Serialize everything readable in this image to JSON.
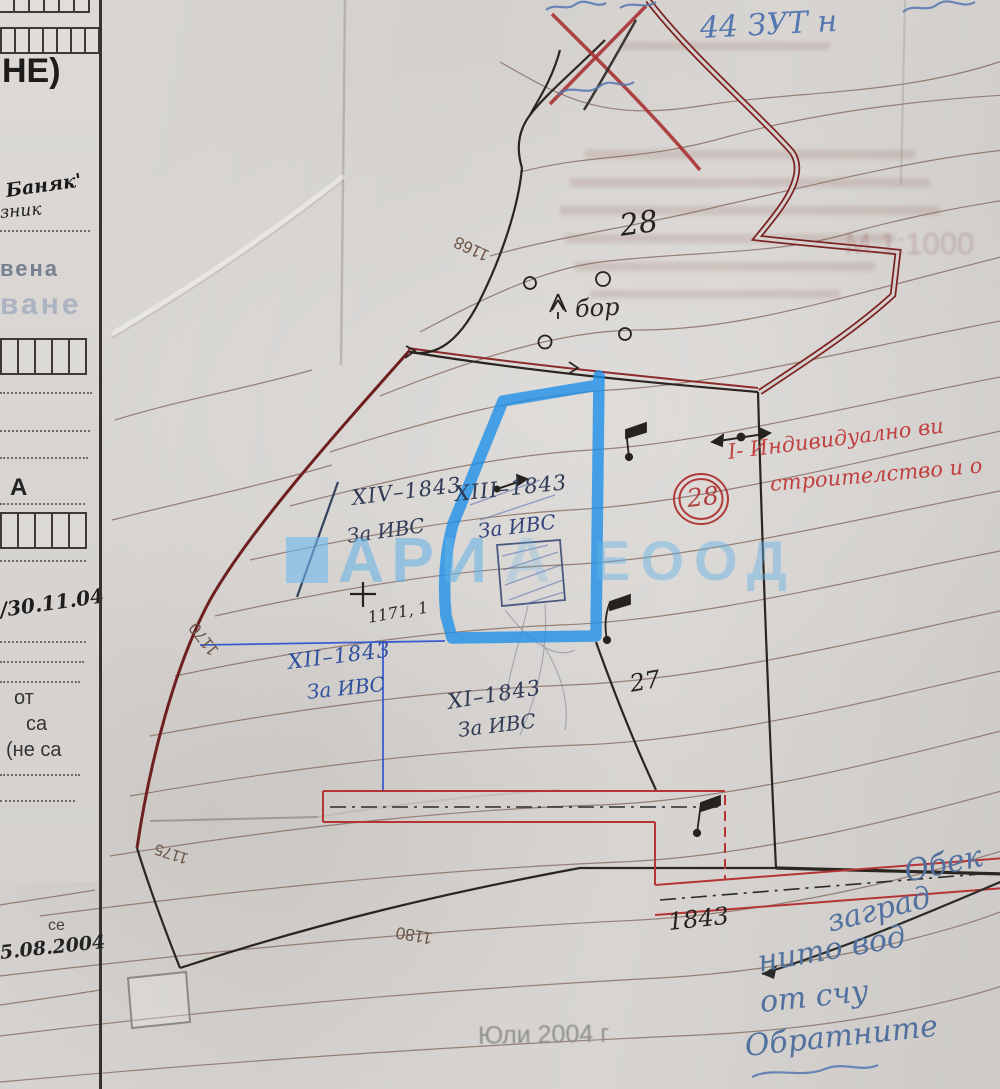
{
  "form": {
    "ne_label": "НЕ)",
    "handwritten_1": "Баняк'",
    "handwritten_2": "зник",
    "stamp_faded_1": "вена",
    "stamp_faded_2": "ване",
    "section_letter": "А",
    "date_note_1": "/30.11.04",
    "printed_ot": "от",
    "printed_sa": "са",
    "printed_ne_sa": "(не са",
    "printed_se": "се",
    "date_note_2": "5.08.2004"
  },
  "map": {
    "top_terrain_number": "28",
    "pine_label": "бор",
    "contour_labels": {
      "l1": "1168",
      "l2": "1170",
      "l3": "1175",
      "l4": "1180"
    },
    "spot_elevation": "1171, 1",
    "parcels": [
      {
        "id": "XIV–1843",
        "use": "За ИВС"
      },
      {
        "id": "XIII–1843",
        "use": "За ИВС"
      },
      {
        "id": "XII–1843",
        "use": "За ИВС"
      },
      {
        "id": "XI–1843",
        "use": "За ИВС"
      }
    ],
    "neighbor_parcel": "27",
    "cadastral_number": "1843",
    "circled_zone_number": "28"
  },
  "annotations": {
    "blue_top_fragment": "44  ЗУТ  н",
    "red_note_line1": "І- Индивидуално ви",
    "red_note_line2": "строителство и о",
    "ghost_scale": "М 1:1000",
    "blue_bottom_notes": [
      "Обек",
      "заград",
      "нито вод",
      "от счу",
      "Обратните"
    ]
  },
  "watermark": {
    "part1": "АРИ",
    "part2": "А",
    "part3": "ЕООД"
  },
  "footer": {
    "survey_date": "Юли 2004 г"
  },
  "colors": {
    "highlight_blue": "#1e90e8",
    "boundary_dark_red": "#7d2424",
    "corridor_red": "#b53434",
    "ink_blue": "#2f4f9e",
    "ink_black": "#262220",
    "red_pen": "#c04040",
    "watermark_blue": "#5fb0e8",
    "contour_brown": "#8a7065",
    "paper": "#d5d2cf"
  }
}
